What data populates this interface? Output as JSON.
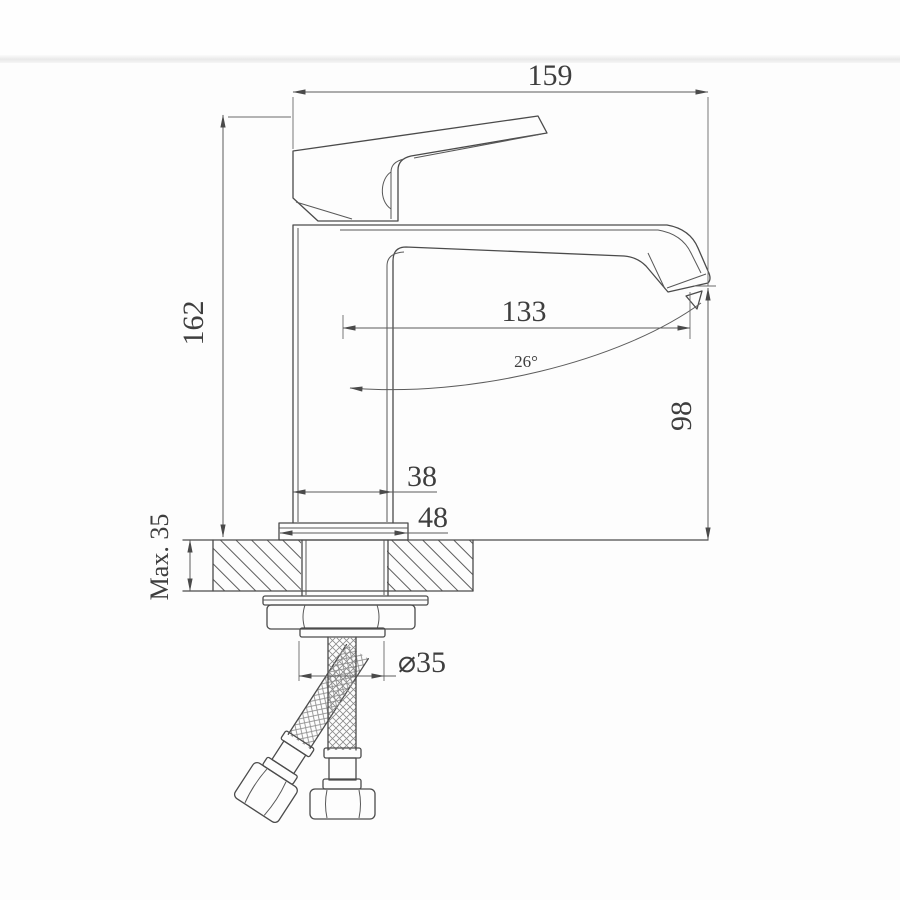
{
  "page": {
    "background": "#fdfdfd",
    "seam_color": "#e9e9e9"
  },
  "drawing": {
    "subject": "single-handle basin faucet side elevation with installation dimensions",
    "units": "mm",
    "line_color": "#4b4b4b",
    "labels": {
      "overall_width": "159",
      "overall_height": "162",
      "spout_reach": "133",
      "stream_angle": "26°",
      "outlet_height": "98",
      "body_depth": "38",
      "base_width": "48",
      "max_mounting_thickness": "Max. 35",
      "hole_diameter": "⌀35"
    }
  }
}
